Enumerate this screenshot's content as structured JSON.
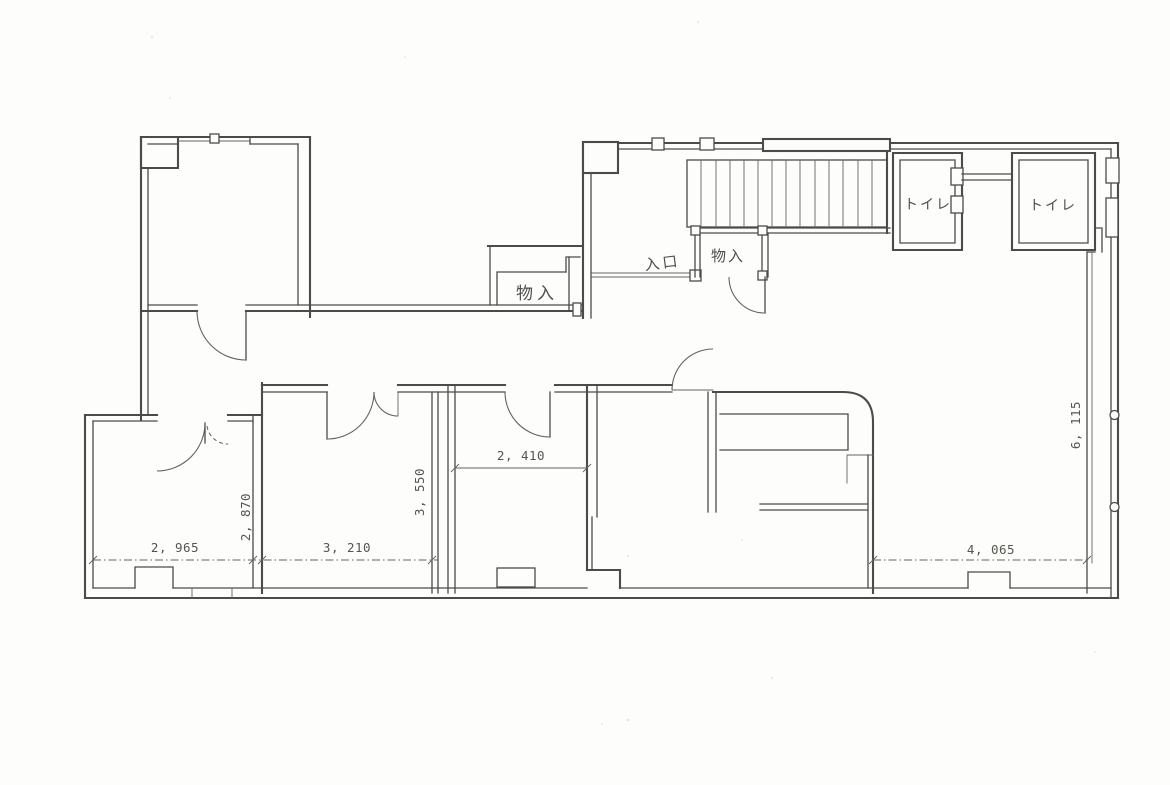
{
  "plan": {
    "labels": {
      "toilet_upper": "トイレ",
      "toilet_right": "トイレ",
      "storage_hall": "物入",
      "storage_stairs": "物入",
      "entrance": "入口"
    },
    "dimensions": {
      "room_left_width": "2, 965",
      "room_left_height": "2, 870",
      "room_mid_width": "3, 210",
      "room_mid_height": "3, 550",
      "room_small_width": "2, 410",
      "room_right_width": "4, 065",
      "room_right_height": "6, 115"
    },
    "colors": {
      "ink": "#4b4b47",
      "paper": "#fdfdfb"
    }
  }
}
